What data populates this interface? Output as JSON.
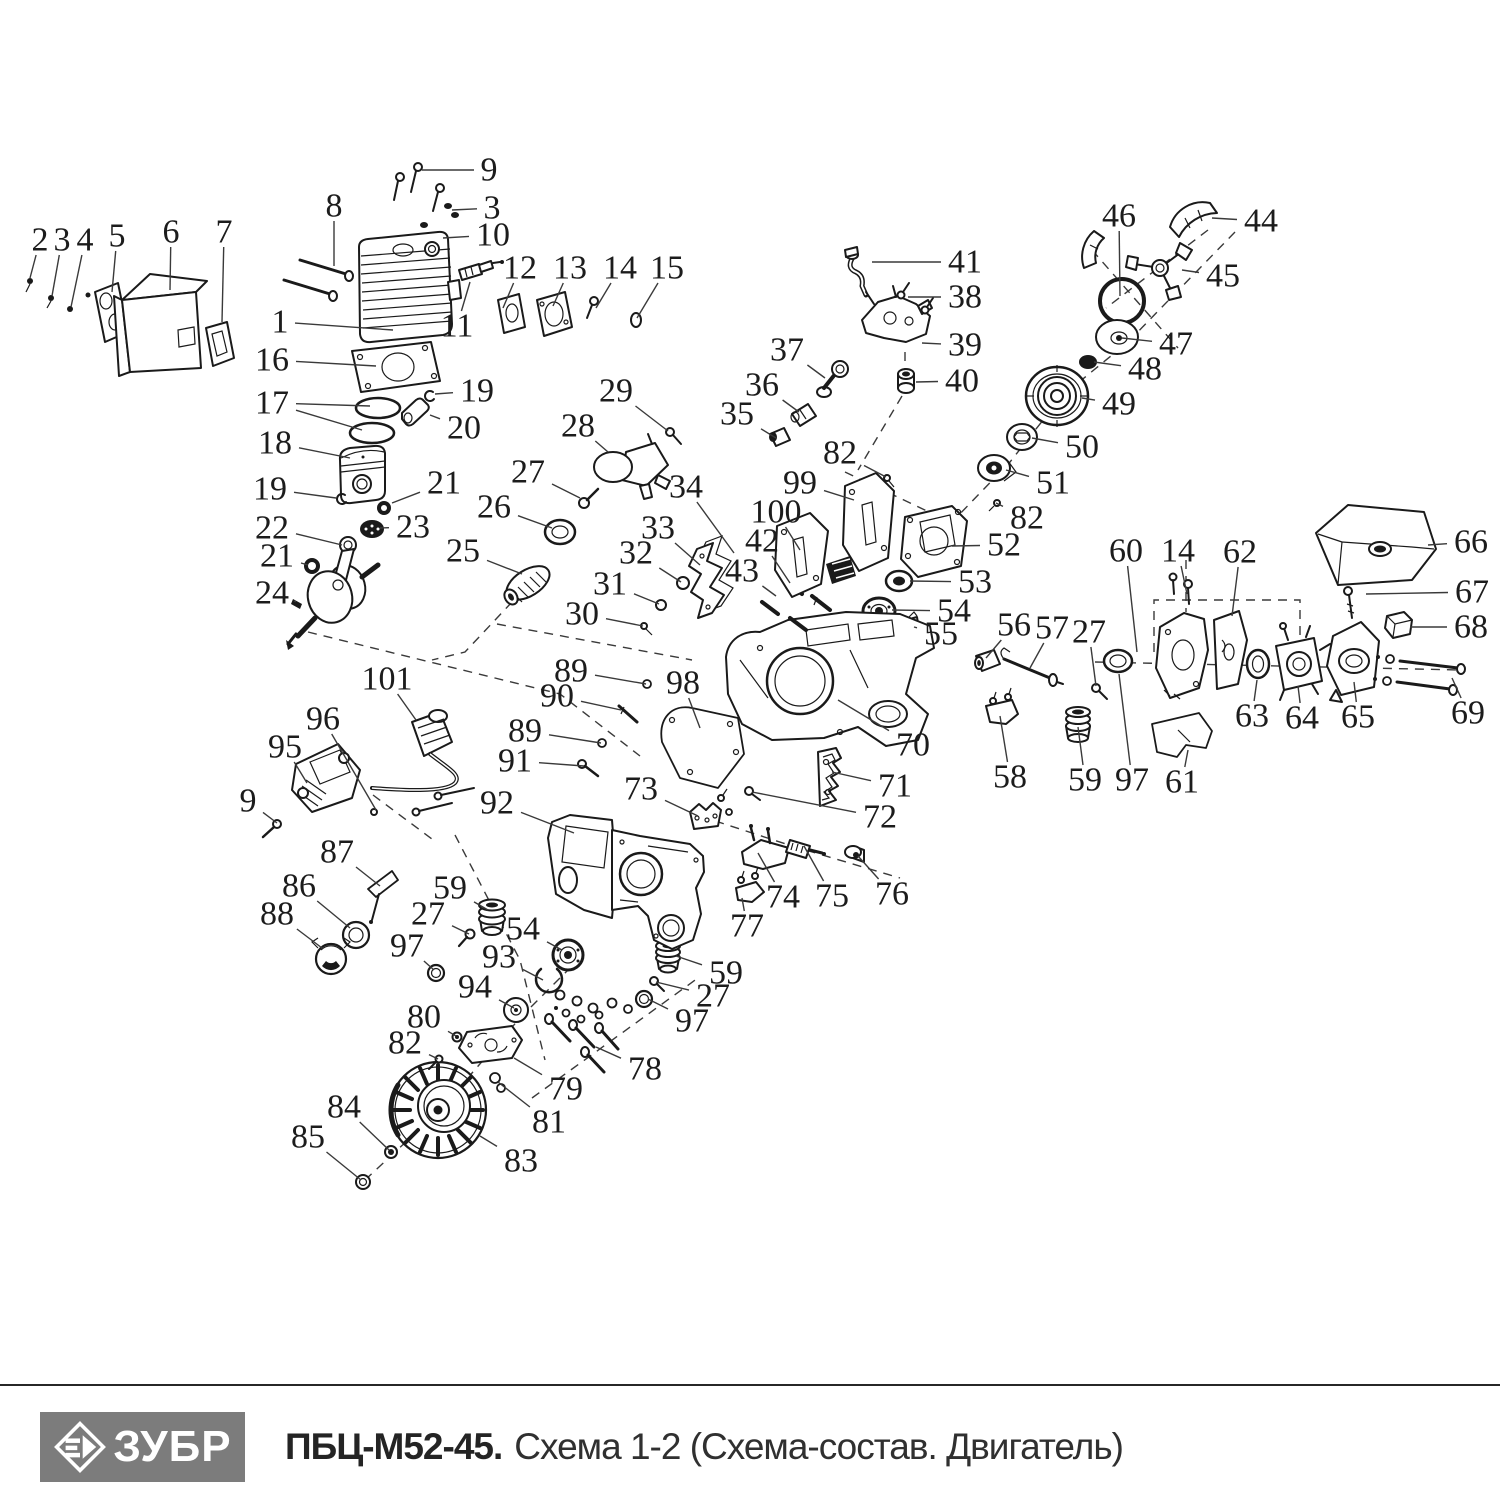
{
  "footer": {
    "brand": "ЗУБР",
    "model": "ПБЦ-М52-45.",
    "schema": "Схема 1-2 (Схема-состав. Двигатель)"
  },
  "diagram": {
    "description": "Exploded-view spare parts diagram of chainsaw engine, callouts 1-101",
    "labels": [
      {
        "n": "1",
        "x": 280,
        "y": 322,
        "t": [
          [
            393,
            330
          ]
        ]
      },
      {
        "n": "2",
        "x": 40,
        "y": 240,
        "t": [
          [
            30,
            278
          ]
        ]
      },
      {
        "n": "3",
        "x": 62,
        "y": 240,
        "t": [
          [
            52,
            296
          ]
        ]
      },
      {
        "n": "4",
        "x": 85,
        "y": 240,
        "t": [
          [
            71,
            307
          ]
        ]
      },
      {
        "n": "5",
        "x": 117,
        "y": 236,
        "t": [
          [
            112,
            292
          ]
        ]
      },
      {
        "n": "6",
        "x": 171,
        "y": 232,
        "t": [
          [
            170,
            290
          ]
        ]
      },
      {
        "n": "7",
        "x": 224,
        "y": 232,
        "t": [
          [
            222,
            322
          ]
        ]
      },
      {
        "n": "8",
        "x": 334,
        "y": 206,
        "t": [
          [
            334,
            266
          ]
        ]
      },
      {
        "n": "9",
        "x": 489,
        "y": 170,
        "t": [
          [
            422,
            170
          ]
        ]
      },
      {
        "n": "3",
        "x": 492,
        "y": 208,
        "t": [
          [
            452,
            210
          ]
        ]
      },
      {
        "n": "10",
        "x": 493,
        "y": 235,
        "t": [
          [
            443,
            238
          ]
        ]
      },
      {
        "n": "11",
        "x": 457,
        "y": 326,
        "t": [
          [
            470,
            282
          ]
        ]
      },
      {
        "n": "12",
        "x": 520,
        "y": 268,
        "t": [
          [
            503,
            308
          ]
        ]
      },
      {
        "n": "13",
        "x": 570,
        "y": 268,
        "t": [
          [
            553,
            306
          ]
        ]
      },
      {
        "n": "14",
        "x": 620,
        "y": 268,
        "t": [
          [
            596,
            308
          ]
        ]
      },
      {
        "n": "15",
        "x": 667,
        "y": 268,
        "t": [
          [
            637,
            318
          ]
        ]
      },
      {
        "n": "16",
        "x": 272,
        "y": 360,
        "t": [
          [
            376,
            366
          ]
        ]
      },
      {
        "n": "17",
        "x": 272,
        "y": 403,
        "t": [
          [
            370,
            406
          ],
          [
            362,
            430
          ]
        ]
      },
      {
        "n": "18",
        "x": 275,
        "y": 443,
        "t": [
          [
            350,
            458
          ]
        ]
      },
      {
        "n": "19",
        "x": 270,
        "y": 489,
        "t": [
          [
            336,
            498
          ]
        ]
      },
      {
        "n": "19",
        "x": 477,
        "y": 391,
        "t": [
          [
            435,
            394
          ]
        ]
      },
      {
        "n": "20",
        "x": 464,
        "y": 428,
        "t": [
          [
            430,
            415
          ]
        ]
      },
      {
        "n": "21",
        "x": 444,
        "y": 483,
        "t": [
          [
            392,
            503
          ]
        ]
      },
      {
        "n": "21",
        "x": 277,
        "y": 556,
        "t": [
          [
            308,
            565
          ]
        ]
      },
      {
        "n": "22",
        "x": 272,
        "y": 528,
        "t": [
          [
            342,
            545
          ]
        ]
      },
      {
        "n": "23",
        "x": 413,
        "y": 527,
        "t": [
          [
            380,
            528
          ]
        ]
      },
      {
        "n": "24",
        "x": 272,
        "y": 593,
        "t": [
          [
            294,
            601
          ]
        ]
      },
      {
        "n": "25",
        "x": 463,
        "y": 551,
        "t": [
          [
            522,
            574
          ]
        ]
      },
      {
        "n": "26",
        "x": 494,
        "y": 507,
        "t": [
          [
            552,
            528
          ]
        ]
      },
      {
        "n": "27",
        "x": 528,
        "y": 472,
        "t": [
          [
            580,
            498
          ]
        ]
      },
      {
        "n": "28",
        "x": 578,
        "y": 426,
        "t": [
          [
            608,
            452
          ]
        ]
      },
      {
        "n": "29",
        "x": 616,
        "y": 391,
        "t": [
          [
            668,
            431
          ]
        ]
      },
      {
        "n": "30",
        "x": 582,
        "y": 614,
        "t": [
          [
            643,
            626
          ]
        ]
      },
      {
        "n": "31",
        "x": 610,
        "y": 584,
        "t": [
          [
            659,
            604
          ]
        ]
      },
      {
        "n": "32",
        "x": 636,
        "y": 553,
        "t": [
          [
            681,
            582
          ]
        ]
      },
      {
        "n": "33",
        "x": 658,
        "y": 528,
        "t": [
          [
            700,
            565
          ]
        ]
      },
      {
        "n": "34",
        "x": 686,
        "y": 487,
        "t": [
          [
            734,
            553
          ]
        ]
      },
      {
        "n": "35",
        "x": 737,
        "y": 414,
        "t": [
          [
            776,
            438
          ]
        ]
      },
      {
        "n": "36",
        "x": 762,
        "y": 385,
        "t": [
          [
            799,
            412
          ]
        ]
      },
      {
        "n": "37",
        "x": 787,
        "y": 350,
        "t": [
          [
            825,
            378
          ]
        ]
      },
      {
        "n": "38",
        "x": 965,
        "y": 297,
        "t": [
          [
            908,
            297
          ]
        ]
      },
      {
        "n": "39",
        "x": 965,
        "y": 345,
        "t": [
          [
            922,
            343
          ]
        ]
      },
      {
        "n": "40",
        "x": 962,
        "y": 381,
        "t": [
          [
            916,
            382
          ]
        ]
      },
      {
        "n": "41",
        "x": 965,
        "y": 262,
        "t": [
          [
            872,
            262
          ]
        ]
      },
      {
        "n": "42",
        "x": 762,
        "y": 541,
        "t": [
          [
            790,
            583
          ]
        ]
      },
      {
        "n": "43",
        "x": 742,
        "y": 571,
        "t": [
          [
            776,
            596
          ]
        ]
      },
      {
        "n": "44",
        "x": 1261,
        "y": 221,
        "t": [
          [
            1212,
            218
          ]
        ]
      },
      {
        "n": "45",
        "x": 1223,
        "y": 276,
        "t": [
          [
            1182,
            270
          ]
        ]
      },
      {
        "n": "46",
        "x": 1119,
        "y": 216,
        "t": [
          [
            1120,
            296
          ]
        ]
      },
      {
        "n": "47",
        "x": 1176,
        "y": 344,
        "t": [
          [
            1122,
            338
          ]
        ]
      },
      {
        "n": "48",
        "x": 1145,
        "y": 369,
        "t": [
          [
            1094,
            362
          ]
        ]
      },
      {
        "n": "49",
        "x": 1119,
        "y": 404,
        "t": [
          [
            1082,
            398
          ]
        ]
      },
      {
        "n": "50",
        "x": 1082,
        "y": 447,
        "t": [
          [
            1032,
            438
          ]
        ]
      },
      {
        "n": "51",
        "x": 1053,
        "y": 483,
        "t": [
          [
            1006,
            470
          ]
        ]
      },
      {
        "n": "52",
        "x": 1004,
        "y": 545,
        "t": [
          [
            952,
            546
          ]
        ]
      },
      {
        "n": "53",
        "x": 975,
        "y": 582,
        "t": [
          [
            910,
            581
          ]
        ]
      },
      {
        "n": "54",
        "x": 954,
        "y": 611,
        "t": [
          [
            892,
            610
          ]
        ]
      },
      {
        "n": "55",
        "x": 941,
        "y": 634,
        "t": [
          [
            914,
            627
          ]
        ]
      },
      {
        "n": "56",
        "x": 1014,
        "y": 625,
        "t": [
          [
            986,
            658
          ]
        ]
      },
      {
        "n": "57",
        "x": 1052,
        "y": 628,
        "t": [
          [
            1030,
            668
          ]
        ]
      },
      {
        "n": "27",
        "x": 1089,
        "y": 632,
        "t": [
          [
            1096,
            686
          ]
        ]
      },
      {
        "n": "58",
        "x": 1010,
        "y": 777,
        "t": [
          [
            1000,
            716
          ]
        ]
      },
      {
        "n": "59",
        "x": 1085,
        "y": 780,
        "t": [
          [
            1078,
            727
          ]
        ]
      },
      {
        "n": "60",
        "x": 1126,
        "y": 551,
        "t": [
          [
            1137,
            652
          ]
        ]
      },
      {
        "n": "14",
        "x": 1178,
        "y": 551,
        "t": [
          [
            1187,
            594
          ]
        ]
      },
      {
        "n": "62",
        "x": 1240,
        "y": 552,
        "t": [
          [
            1232,
            616
          ]
        ]
      },
      {
        "n": "66",
        "x": 1471,
        "y": 542,
        "t": [
          [
            1428,
            545
          ]
        ]
      },
      {
        "n": "67",
        "x": 1472,
        "y": 592,
        "t": [
          [
            1366,
            594
          ]
        ]
      },
      {
        "n": "68",
        "x": 1471,
        "y": 627,
        "t": [
          [
            1410,
            627
          ]
        ]
      },
      {
        "n": "69",
        "x": 1468,
        "y": 713,
        "t": [
          [
            1452,
            678
          ]
        ]
      },
      {
        "n": "63",
        "x": 1252,
        "y": 716,
        "t": [
          [
            1257,
            680
          ]
        ]
      },
      {
        "n": "64",
        "x": 1302,
        "y": 718,
        "t": [
          [
            1298,
            686
          ]
        ]
      },
      {
        "n": "65",
        "x": 1358,
        "y": 717,
        "t": [
          [
            1354,
            682
          ]
        ]
      },
      {
        "n": "61",
        "x": 1182,
        "y": 782,
        "t": [
          [
            1188,
            750
          ]
        ]
      },
      {
        "n": "97",
        "x": 1132,
        "y": 780,
        "t": [
          [
            1119,
            674
          ]
        ]
      },
      {
        "n": "70",
        "x": 913,
        "y": 745,
        "t": [
          [
            838,
            700
          ]
        ]
      },
      {
        "n": "71",
        "x": 895,
        "y": 786,
        "t": [
          [
            832,
            772
          ]
        ]
      },
      {
        "n": "72",
        "x": 880,
        "y": 817,
        "t": [
          [
            752,
            792
          ]
        ]
      },
      {
        "n": "73",
        "x": 641,
        "y": 789,
        "t": [
          [
            698,
            816
          ]
        ]
      },
      {
        "n": "74",
        "x": 783,
        "y": 897,
        "t": [
          [
            758,
            853
          ]
        ]
      },
      {
        "n": "75",
        "x": 832,
        "y": 896,
        "t": [
          [
            804,
            846
          ]
        ]
      },
      {
        "n": "76",
        "x": 892,
        "y": 894,
        "t": [
          [
            858,
            856
          ]
        ]
      },
      {
        "n": "77",
        "x": 747,
        "y": 926,
        "t": [
          [
            742,
            898
          ]
        ]
      },
      {
        "n": "78",
        "x": 645,
        "y": 1069,
        "t": [
          [
            596,
            1047
          ]
        ]
      },
      {
        "n": "79",
        "x": 566,
        "y": 1089,
        "t": [
          [
            514,
            1058
          ]
        ]
      },
      {
        "n": "80",
        "x": 424,
        "y": 1017,
        "t": [
          [
            456,
            1036
          ]
        ]
      },
      {
        "n": "81",
        "x": 549,
        "y": 1122,
        "t": [
          [
            498,
            1082
          ]
        ]
      },
      {
        "n": "82",
        "x": 840,
        "y": 453,
        "t": [
          [
            886,
            477
          ]
        ]
      },
      {
        "n": "82",
        "x": 1027,
        "y": 518,
        "t": [
          [
            996,
            503
          ]
        ]
      },
      {
        "n": "82",
        "x": 405,
        "y": 1043,
        "t": [
          [
            438,
            1059
          ]
        ]
      },
      {
        "n": "83",
        "x": 521,
        "y": 1161,
        "t": [
          [
            480,
            1136
          ]
        ]
      },
      {
        "n": "84",
        "x": 344,
        "y": 1107,
        "t": [
          [
            389,
            1150
          ]
        ]
      },
      {
        "n": "85",
        "x": 308,
        "y": 1137,
        "t": [
          [
            361,
            1180
          ]
        ]
      },
      {
        "n": "86",
        "x": 299,
        "y": 886,
        "t": [
          [
            350,
            928
          ]
        ]
      },
      {
        "n": "87",
        "x": 337,
        "y": 852,
        "t": [
          [
            380,
            886
          ]
        ]
      },
      {
        "n": "88",
        "x": 277,
        "y": 914,
        "t": [
          [
            322,
            948
          ]
        ]
      },
      {
        "n": "89",
        "x": 571,
        "y": 671,
        "t": [
          [
            646,
            684
          ]
        ]
      },
      {
        "n": "90",
        "x": 557,
        "y": 696,
        "t": [
          [
            621,
            710
          ]
        ]
      },
      {
        "n": "89",
        "x": 525,
        "y": 731,
        "t": [
          [
            601,
            743
          ]
        ]
      },
      {
        "n": "91",
        "x": 515,
        "y": 761,
        "t": [
          [
            584,
            766
          ]
        ]
      },
      {
        "n": "92",
        "x": 497,
        "y": 803,
        "t": [
          [
            574,
            833
          ]
        ]
      },
      {
        "n": "93",
        "x": 499,
        "y": 957,
        "t": [
          [
            543,
            980
          ]
        ]
      },
      {
        "n": "94",
        "x": 475,
        "y": 987,
        "t": [
          [
            514,
            1008
          ]
        ]
      },
      {
        "n": "95",
        "x": 285,
        "y": 747,
        "t": [
          [
            307,
            783
          ]
        ]
      },
      {
        "n": "96",
        "x": 323,
        "y": 719,
        "t": [
          [
            376,
            810
          ]
        ]
      },
      {
        "n": "9",
        "x": 248,
        "y": 801,
        "t": [
          [
            277,
            823
          ]
        ]
      },
      {
        "n": "97",
        "x": 407,
        "y": 946,
        "t": [
          [
            434,
            970
          ]
        ]
      },
      {
        "n": "27",
        "x": 428,
        "y": 914,
        "t": [
          [
            469,
            934
          ]
        ]
      },
      {
        "n": "59",
        "x": 450,
        "y": 888,
        "t": [
          [
            488,
            910
          ]
        ]
      },
      {
        "n": "54",
        "x": 523,
        "y": 929,
        "t": [
          [
            562,
            950
          ]
        ]
      },
      {
        "n": "97",
        "x": 692,
        "y": 1021,
        "t": [
          [
            648,
            999
          ]
        ]
      },
      {
        "n": "27",
        "x": 713,
        "y": 996,
        "t": [
          [
            656,
            982
          ]
        ]
      },
      {
        "n": "59",
        "x": 726,
        "y": 973,
        "t": [
          [
            676,
            956
          ]
        ]
      },
      {
        "n": "98",
        "x": 683,
        "y": 683,
        "t": [
          [
            700,
            728
          ]
        ]
      },
      {
        "n": "99",
        "x": 800,
        "y": 483,
        "t": [
          [
            854,
            500
          ]
        ]
      },
      {
        "n": "100",
        "x": 776,
        "y": 512,
        "t": [
          [
            800,
            550
          ]
        ]
      },
      {
        "n": "101",
        "x": 387,
        "y": 679,
        "t": [
          [
            416,
            720
          ]
        ]
      }
    ]
  }
}
